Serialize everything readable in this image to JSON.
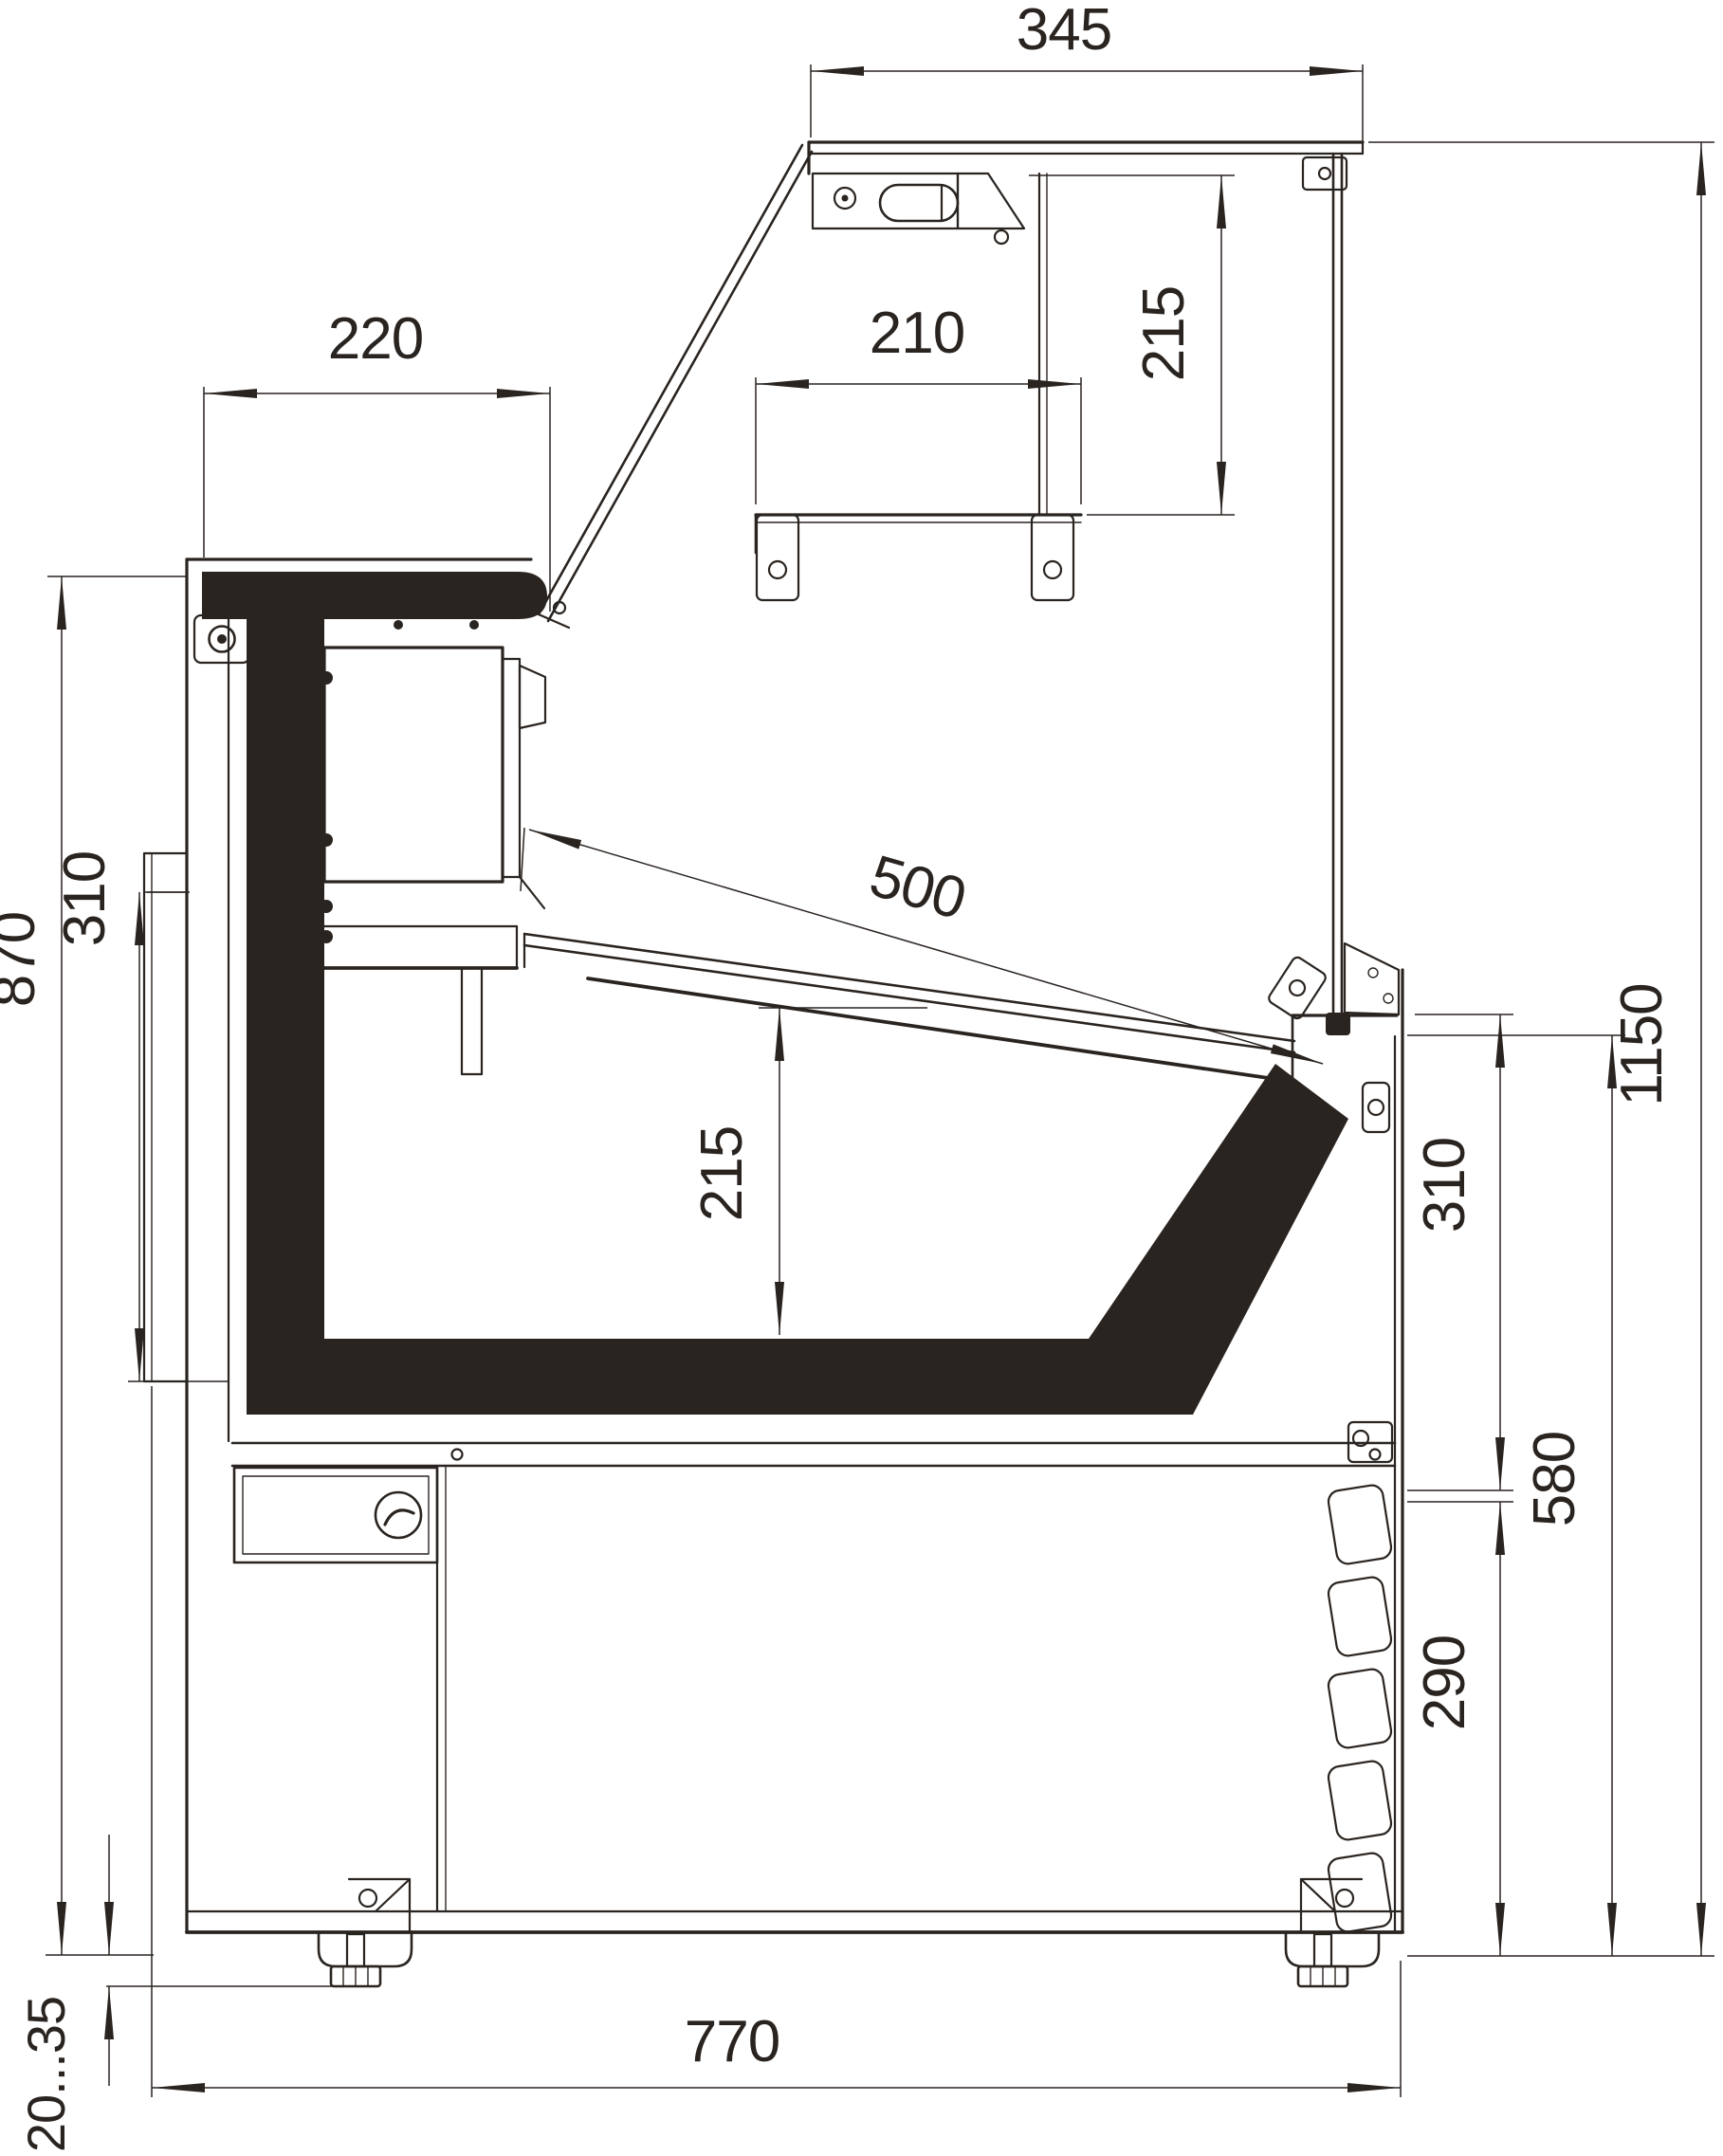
{
  "drawing": {
    "title": "Serve-over refrigerated display counter — side section",
    "type": "technical-dimension-drawing",
    "units": "mm",
    "colors": {
      "background": "#ffffff",
      "line": "#2a2420"
    },
    "dimensions": {
      "canopy_depth": {
        "label": "345",
        "orientation": "horizontal",
        "region": "top canopy width"
      },
      "canopy_to_shelf": {
        "label": "215",
        "orientation": "vertical",
        "region": "canopy underside to shelf"
      },
      "worktop_depth": {
        "label": "220",
        "orientation": "horizontal",
        "region": "rear worktop depth"
      },
      "shelf_depth": {
        "label": "210",
        "orientation": "horizontal",
        "region": "intermediate shelf depth"
      },
      "display_opening": {
        "label": "500",
        "orientation": "diagonal",
        "region": "display opening / flap glass"
      },
      "well_depth": {
        "label": "215",
        "orientation": "vertical",
        "region": "display well depth"
      },
      "rear_panel_height": {
        "label": "310",
        "orientation": "vertical",
        "region": "rear service panel height"
      },
      "worktop_height": {
        "label": "870",
        "orientation": "vertical",
        "region": "floor to worktop"
      },
      "overall_height": {
        "label": "1150",
        "orientation": "vertical",
        "region": "overall height"
      },
      "glass_sill_band": {
        "label": "310",
        "orientation": "vertical",
        "region": "sill to louver band"
      },
      "sill_height": {
        "label": "580",
        "orientation": "vertical",
        "region": "floor to front sill"
      },
      "louver_height": {
        "label": "290",
        "orientation": "vertical",
        "region": "front louver panel height"
      },
      "overall_depth": {
        "label": "770",
        "orientation": "horizontal",
        "region": "overall depth"
      },
      "foot_adjust_range": {
        "label": "20...35",
        "orientation": "vertical",
        "region": "adjustable foot range"
      }
    }
  }
}
